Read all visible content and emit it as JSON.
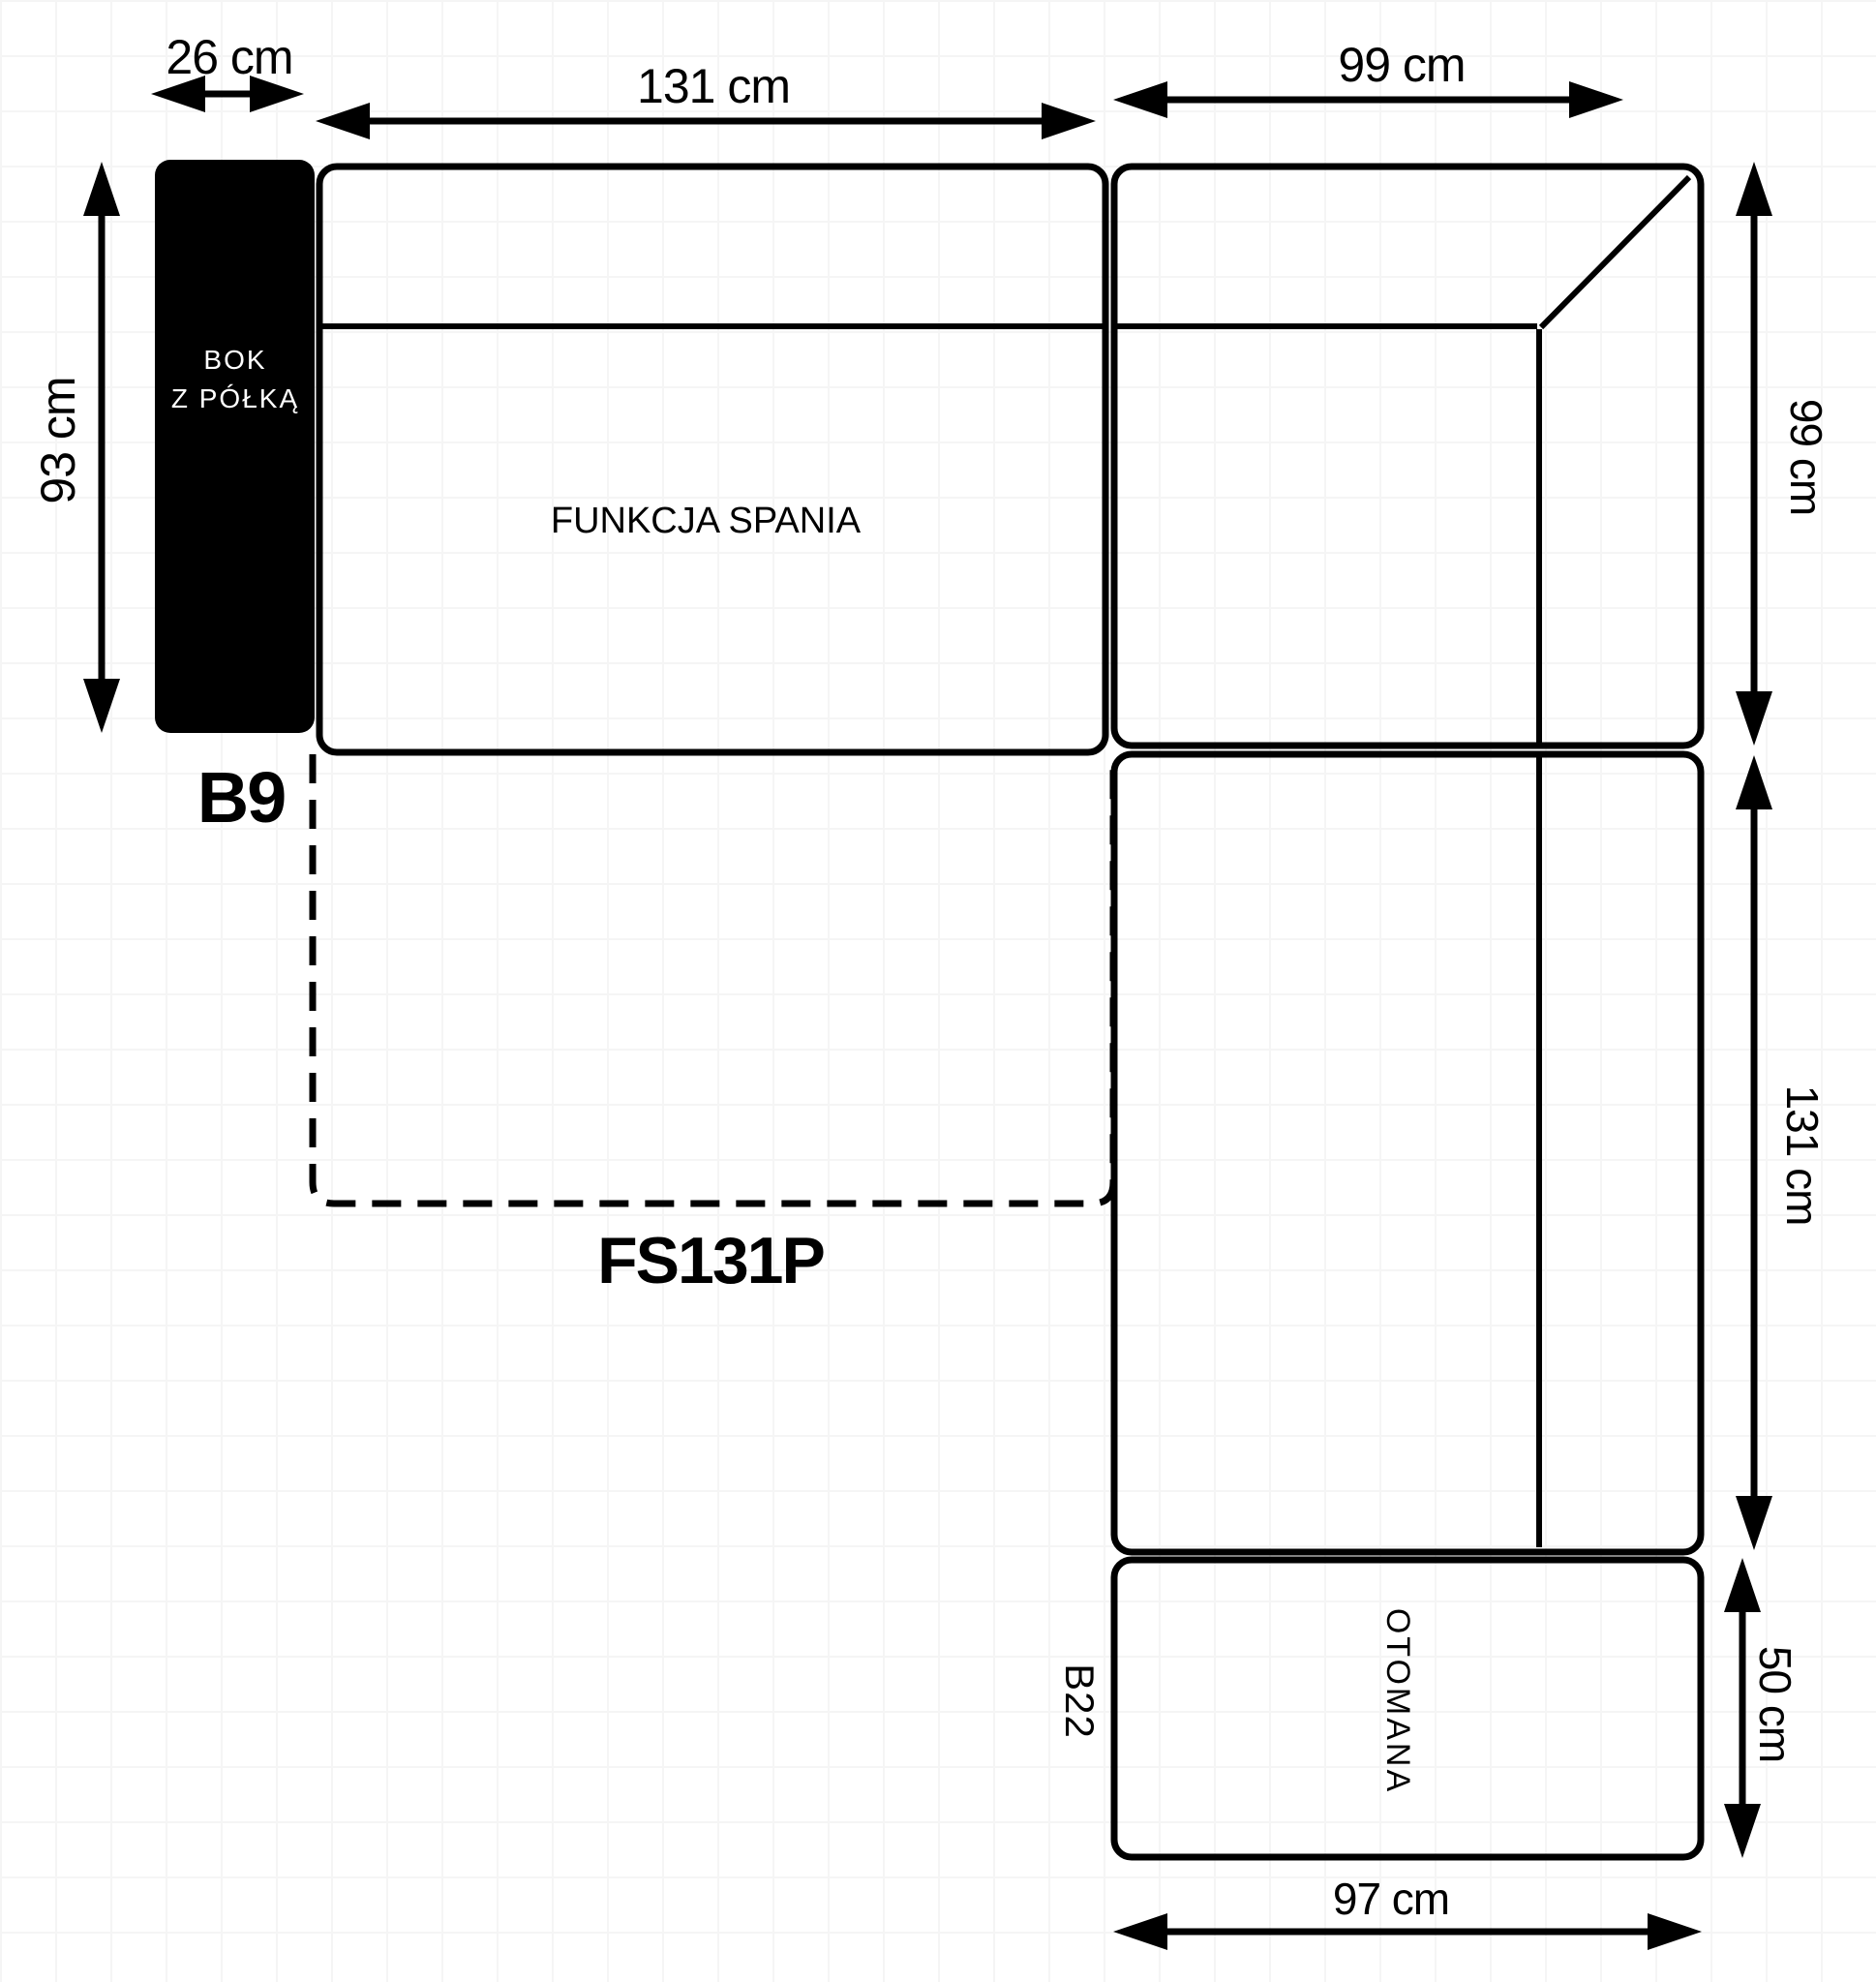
{
  "diagram": {
    "side_panel": {
      "line1": "BOK",
      "line2": "Z PÓŁKĄ",
      "code": "B9",
      "width_label": "26 cm",
      "height_label": "93 cm"
    },
    "seat_section": {
      "label": "FUNKCJA SPANIA",
      "width_label": "131 cm"
    },
    "corner_section": {
      "width_label": "99 cm",
      "depth_label": "99 cm"
    },
    "chaise_section": {
      "length_label": "131 cm"
    },
    "sleeping_module": {
      "code": "FS131P"
    },
    "ottoman": {
      "label": "OTOMANA",
      "code": "B22",
      "depth_label": "50 cm",
      "width_label": "97 cm"
    },
    "colors": {
      "line": "#000000",
      "panel_fill": "#000000",
      "panel_text": "#ffffff",
      "background": "#ffffff",
      "grid": "#f5f5f5"
    }
  }
}
